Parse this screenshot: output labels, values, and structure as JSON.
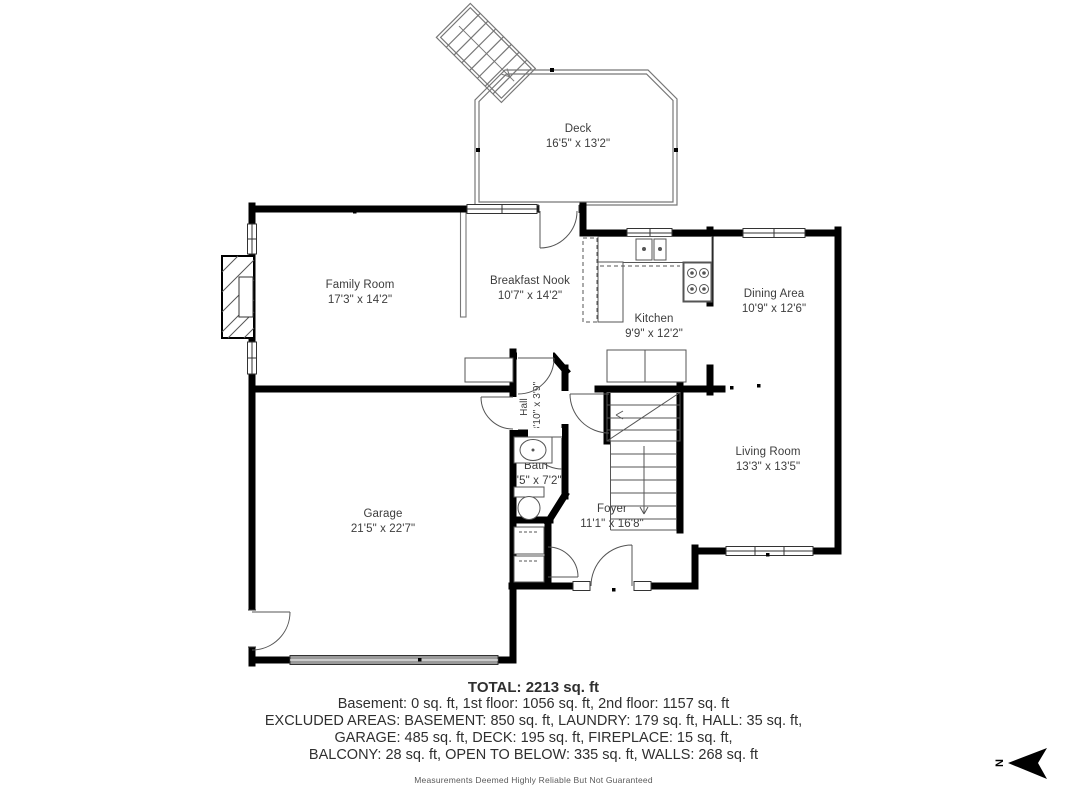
{
  "plan": {
    "rooms": {
      "deck": {
        "name": "Deck",
        "dims": "16'5\" x 13'2\""
      },
      "family_room": {
        "name": "Family Room",
        "dims": "17'3\" x 14'2\""
      },
      "breakfast_nook": {
        "name": "Breakfast Nook",
        "dims": "10'7\" x 14'2\""
      },
      "kitchen": {
        "name": "Kitchen",
        "dims": "9'9\" x 12'2\""
      },
      "dining_area": {
        "name": "Dining Area",
        "dims": "10'9\" x 12'6\""
      },
      "living_room": {
        "name": "Living Room",
        "dims": "13'3\" x 13'5\""
      },
      "hall": {
        "name": "Hall",
        "dims": "3'10\" x 3'9\""
      },
      "bath": {
        "name": "Bath",
        "dims": "4'5\" x 7'2\""
      },
      "foyer": {
        "name": "Foyer",
        "dims": "11'1\" x 16'8\""
      },
      "garage": {
        "name": "Garage",
        "dims": "21'5\" x 22'7\""
      }
    },
    "compass": {
      "label": "N"
    }
  },
  "summary": {
    "total": "TOTAL: 2213 sq. ft",
    "floors": "Basement: 0 sq. ft, 1st floor: 1056 sq. ft, 2nd floor: 1157 sq. ft",
    "excluded_1": "EXCLUDED AREAS: BASEMENT: 850 sq. ft, LAUNDRY: 179 sq. ft, HALL: 35 sq. ft,",
    "excluded_2": "GARAGE: 485 sq. ft, DECK: 195 sq. ft, FIREPLACE: 15 sq. ft,",
    "excluded_3": "BALCONY: 28 sq. ft, OPEN TO BELOW: 335 sq. ft, WALLS: 268 sq. ft",
    "disclaimer": "Measurements Deemed Highly Reliable But Not Guaranteed"
  },
  "colors": {
    "wall": "#000000",
    "thin_line": "#666666",
    "deck_line": "#777777",
    "text": "#3d3d3d",
    "garage_door": "#9a9a9a"
  }
}
